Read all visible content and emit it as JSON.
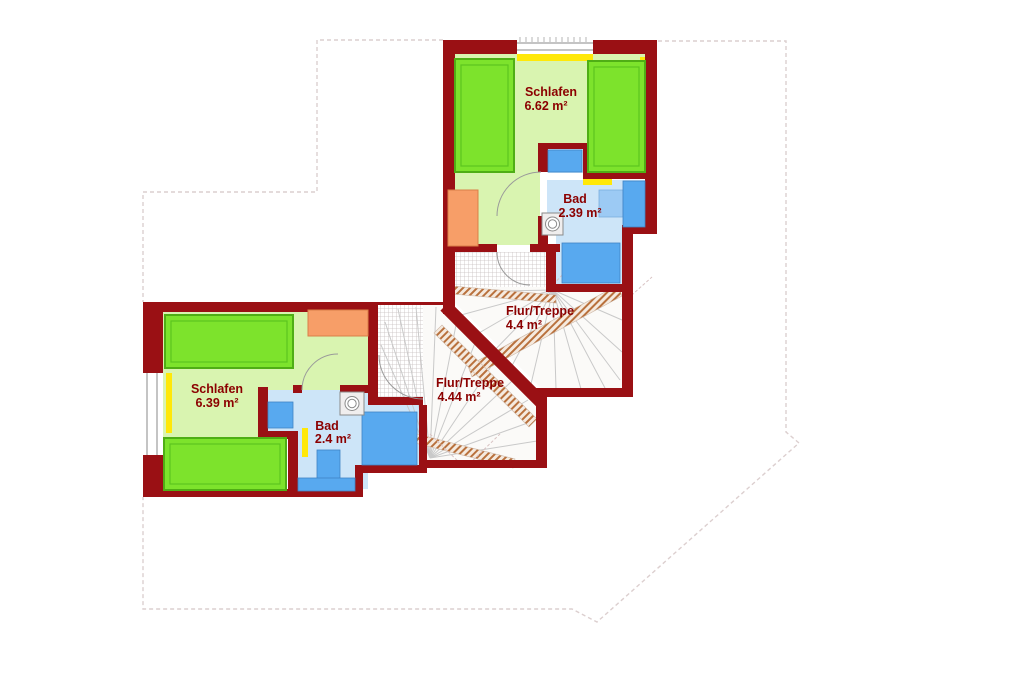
{
  "title": "Dachgeschoss Grundriss",
  "rooms": [
    {
      "name": "Schlafen",
      "area": "6.62 m²"
    },
    {
      "name": "Bad",
      "area": "2.39 m²"
    },
    {
      "name": "Flur/Treppe",
      "area": "4.4 m²"
    },
    {
      "name": "Flur/Treppe",
      "area": "4.44 m²"
    },
    {
      "name": "Schlafen",
      "area": "6.39 m²"
    },
    {
      "name": "Bad",
      "area": "2.4 m²"
    }
  ],
  "colors": {
    "wall": "#9a1014",
    "room_floor_green": "#d9f4b0",
    "bed_green": "#7de32c",
    "bed_border": "#4fae15",
    "bath_floor_blue": "#cde5f8",
    "fixture_blue": "#58a9ef",
    "fixture_blue_light": "#9ccaf4",
    "accent_yellow": "#ffe808",
    "furniture_orange": "#f79e68",
    "label_text": "#8b0000",
    "roof_outline": "#dccfcf",
    "stair_tread": "#c9c9c9",
    "stair_band": "#b9713d"
  }
}
